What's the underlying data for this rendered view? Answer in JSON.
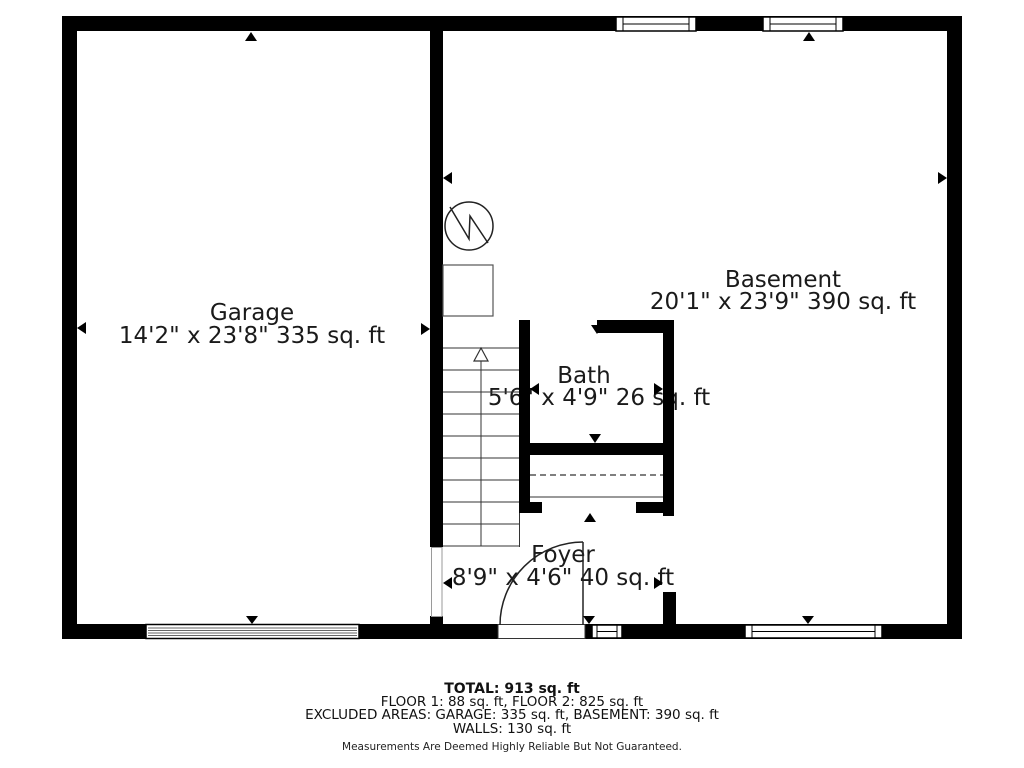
{
  "colors": {
    "wall": "#000000",
    "line": "#333333",
    "text": "#1a1a1a"
  },
  "rooms": {
    "garage": {
      "name": "Garage",
      "dims": "14'2\" x 23'8\" 335 sq. ft"
    },
    "basement": {
      "name": "Basement",
      "dims": "20'1\" x 23'9\" 390 sq. ft"
    },
    "bath": {
      "name": "Bath",
      "dims": "5'6\" x 4'9\" 26 sq. ft"
    },
    "foyer": {
      "name": "Foyer",
      "dims": "8'9\" x 4'6\" 40 sq. ft"
    }
  },
  "summary": {
    "total": "TOTAL: 913 sq. ft",
    "floors": "FLOOR 1: 88 sq. ft, FLOOR 2: 825 sq. ft",
    "excluded": "EXCLUDED AREAS: GARAGE: 335 sq. ft, BASEMENT: 390 sq. ft",
    "walls": "WALLS: 130 sq. ft",
    "disclaimer": "Measurements Are Deemed Highly Reliable But Not Guaranteed."
  },
  "symbols": {
    "water_heater": "circle-with-zigzag",
    "stairs": "treads-with-up-arrow",
    "entry_door": "quarter-arc-swing",
    "markers": "small-black-triangle-pointers"
  }
}
